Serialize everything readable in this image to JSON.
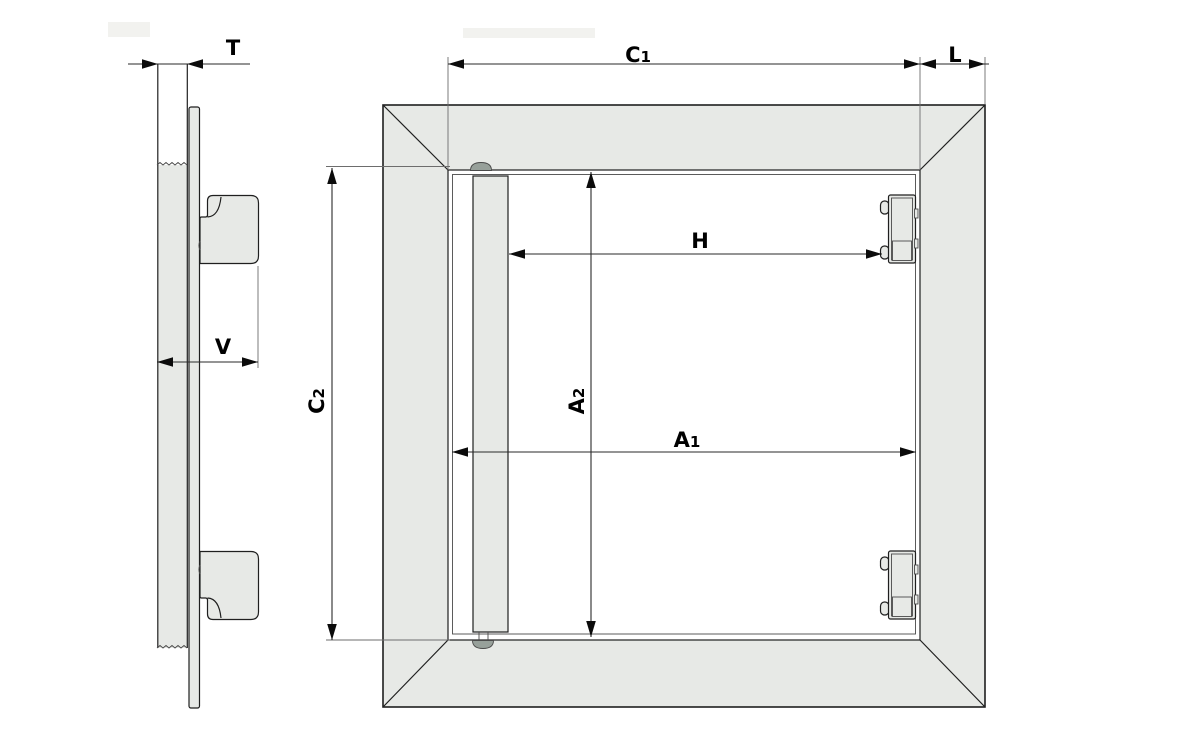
{
  "drawing": {
    "labels": {
      "t": "T",
      "l": "L",
      "v": "V",
      "h": "H",
      "c1": {
        "main": "C",
        "sub": "1"
      },
      "c2": {
        "main": "C",
        "sub": "2"
      },
      "a1": {
        "main": "A",
        "sub": "1"
      },
      "a2": {
        "main": "A",
        "sub": "2"
      }
    },
    "colors": {
      "background": "#ffffff",
      "panel_fill": "#e7e9e6",
      "outline": "#1f1f1f",
      "dimension": "#2a2a2a",
      "pin_fill": "#97a09a"
    }
  }
}
